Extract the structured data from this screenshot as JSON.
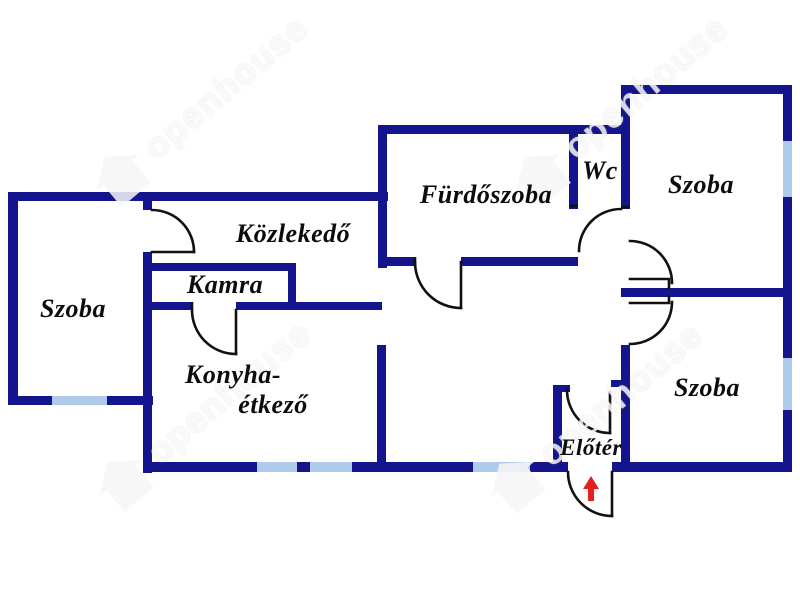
{
  "title": "Floor plan",
  "colors": {
    "wall": "#14148c",
    "window": "#aecbe9",
    "door": "#111111",
    "arrow": "#e41f1f",
    "watermark": "rgba(255,255,255,0.78)"
  },
  "rooms": {
    "szoba_left": "Szoba",
    "kozlekedo": "Közlekedő",
    "kamra": "Kamra",
    "konyha_line1": "Konyha-",
    "konyha_line2": "étkező",
    "furdoszoba": "Fürdőszoba",
    "wc": "Wc",
    "szoba_top": "Szoba",
    "szoba_bottom": "Szoba",
    "eloter": "Előtér"
  },
  "watermark": {
    "text": "openhouse"
  },
  "entrance": {
    "symbol": "red-arrow-up"
  }
}
